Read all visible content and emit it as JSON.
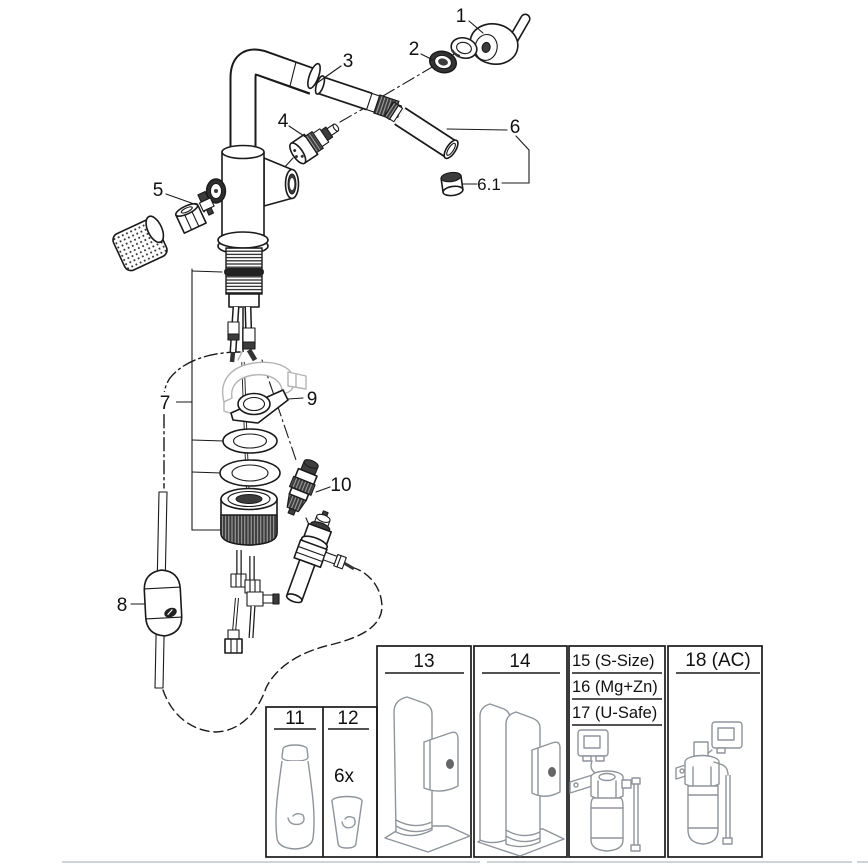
{
  "diagram": {
    "parts": {
      "p1": "1",
      "p2": "2",
      "p3": "3",
      "p4": "4",
      "p5": "5",
      "p6": "6",
      "p6_1": "6.1",
      "p7": "7",
      "p8": "8",
      "p9": "9",
      "p10": "10"
    },
    "boxes": {
      "b11": "11",
      "b12": "12",
      "b12_qty": "6x",
      "b13": "13",
      "b14": "14",
      "b15": "15 (S-Size)",
      "b16": "16 (Mg+Zn)",
      "b17": "17 (U-Safe)",
      "b18": "18 (AC)"
    },
    "colors": {
      "line": "#1a1a1a",
      "ghost": "#b4b4b4",
      "product_line": "#8f949b",
      "page_edge": "#cdd3da",
      "background": "#ffffff"
    }
  }
}
